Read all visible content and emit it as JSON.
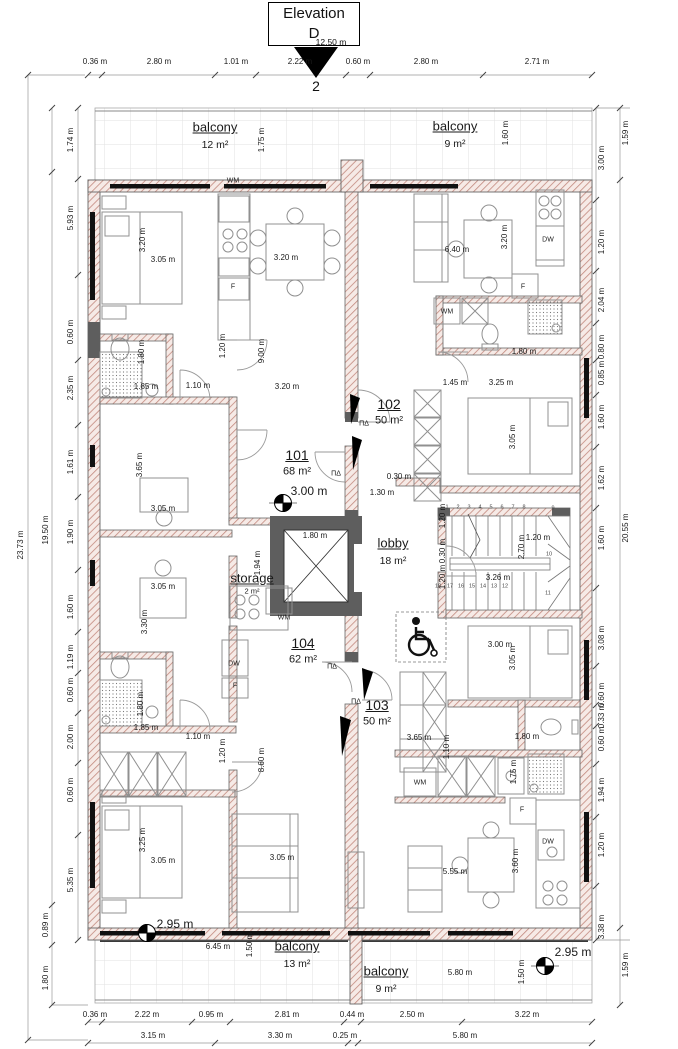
{
  "marker": {
    "title_line1": "Elevation",
    "title_line2": "D",
    "number": "2",
    "span_label": "12.50 m"
  },
  "colors": {
    "hatch_line": "#c2897e",
    "hatch_bg": "#f6eae6",
    "wall_dark": "#5e5e5e",
    "window": "#111111",
    "furniture": "#909090",
    "tile_line": "#e2e2e2",
    "dim_text": "#1a1a1a"
  },
  "dimensions": {
    "top": {
      "y": 62,
      "items": [
        {
          "t": "0.36 m",
          "x": 95
        },
        {
          "t": "2.80 m",
          "x": 159
        },
        {
          "t": "1.01 m",
          "x": 236
        },
        {
          "t": "2.22 m",
          "x": 300
        },
        {
          "t": "0.60 m",
          "x": 358
        },
        {
          "t": "2.80 m",
          "x": 426
        },
        {
          "t": "2.71 m",
          "x": 537
        }
      ]
    },
    "bottom1": {
      "y": 1015,
      "items": [
        {
          "t": "0.36 m",
          "x": 95
        },
        {
          "t": "2.22 m",
          "x": 147
        },
        {
          "t": "0.95 m",
          "x": 211
        },
        {
          "t": "2.81 m",
          "x": 287
        },
        {
          "t": "0.44 m",
          "x": 352
        },
        {
          "t": "2.50 m",
          "x": 412
        },
        {
          "t": "3.22 m",
          "x": 527
        }
      ]
    },
    "bottom2": {
      "y": 1036,
      "items": [
        {
          "t": "3.15 m",
          "x": 153
        },
        {
          "t": "3.30 m",
          "x": 280
        },
        {
          "t": "0.25 m",
          "x": 345
        },
        {
          "t": "5.80 m",
          "x": 465
        }
      ]
    },
    "left_inner": {
      "x": 71,
      "items": [
        {
          "t": "1.74 m",
          "y": 140
        },
        {
          "t": "5.93 m",
          "y": 218
        },
        {
          "t": "0.60 m",
          "y": 332
        },
        {
          "t": "2.35 m",
          "y": 388
        },
        {
          "t": "1.61 m",
          "y": 462
        },
        {
          "t": "1.90 m",
          "y": 532
        },
        {
          "t": "1.60 m",
          "y": 607
        },
        {
          "t": "1.19 m",
          "y": 657
        },
        {
          "t": "0.60 m",
          "y": 690
        },
        {
          "t": "2.00 m",
          "y": 737
        },
        {
          "t": "0.60 m",
          "y": 790
        },
        {
          "t": "5.35 m",
          "y": 880
        }
      ]
    },
    "left_mid": {
      "x": 46,
      "items": [
        {
          "t": "19.50 m",
          "y": 530
        },
        {
          "t": "0.89 m",
          "y": 925
        },
        {
          "t": "1.80 m",
          "y": 978
        }
      ]
    },
    "left_outer": {
      "x": 21,
      "items": [
        {
          "t": "23.73 m",
          "y": 545
        }
      ]
    },
    "right_inner": {
      "x": 602,
      "items": [
        {
          "t": "3.00 m",
          "y": 158
        },
        {
          "t": "1.20 m",
          "y": 242
        },
        {
          "t": "2.04 m",
          "y": 300
        },
        {
          "t": "0.80 m",
          "y": 347
        },
        {
          "t": "0.85 m",
          "y": 373
        },
        {
          "t": "1.60 m",
          "y": 417
        },
        {
          "t": "1.62 m",
          "y": 478
        },
        {
          "t": "1.60 m",
          "y": 538
        },
        {
          "t": "3.08 m",
          "y": 638
        },
        {
          "t": "0.60 m",
          "y": 695
        },
        {
          "t": "0.33 m",
          "y": 716
        },
        {
          "t": "0.60 m",
          "y": 739
        },
        {
          "t": "1.94 m",
          "y": 790
        },
        {
          "t": "1.20 m",
          "y": 845
        },
        {
          "t": "3.38 m",
          "y": 927
        }
      ]
    },
    "right_outer": {
      "x": 626,
      "items": [
        {
          "t": "1.59 m",
          "y": 133
        },
        {
          "t": "20.55 m",
          "y": 528
        },
        {
          "t": "1.59 m",
          "y": 965
        }
      ]
    }
  },
  "interior_dims": [
    {
      "t": "1.75 m",
      "x": 262,
      "y": 140,
      "v": 1
    },
    {
      "t": "1.60 m",
      "x": 506,
      "y": 133,
      "v": 1
    },
    {
      "t": "3.20 m",
      "x": 143,
      "y": 240,
      "v": 1
    },
    {
      "t": "3.05 m",
      "x": 163,
      "y": 260
    },
    {
      "t": "3.20 m",
      "x": 286,
      "y": 258
    },
    {
      "t": "6.40 m",
      "x": 457,
      "y": 250
    },
    {
      "t": "3.20 m",
      "x": 505,
      "y": 237,
      "v": 1
    },
    {
      "t": "1.80 m",
      "x": 524,
      "y": 352
    },
    {
      "t": "1.45 m",
      "x": 455,
      "y": 383
    },
    {
      "t": "3.25 m",
      "x": 501,
      "y": 383
    },
    {
      "t": "3.05 m",
      "x": 513,
      "y": 437,
      "v": 1
    },
    {
      "t": "3.00 m",
      "x": 309,
      "y": 491,
      "lg": 1
    },
    {
      "t": "0.30 m",
      "x": 399,
      "y": 477
    },
    {
      "t": "1.30 m",
      "x": 382,
      "y": 493
    },
    {
      "t": "1.80 m",
      "x": 142,
      "y": 352,
      "v": 1
    },
    {
      "t": "1.85 m",
      "x": 146,
      "y": 387
    },
    {
      "t": "1.10 m",
      "x": 198,
      "y": 386
    },
    {
      "t": "1.20 m",
      "x": 223,
      "y": 346,
      "v": 1
    },
    {
      "t": "9.00 m",
      "x": 262,
      "y": 351,
      "v": 1
    },
    {
      "t": "3.20 m",
      "x": 287,
      "y": 387
    },
    {
      "t": "3.65 m",
      "x": 140,
      "y": 465,
      "v": 1
    },
    {
      "t": "3.05 m",
      "x": 163,
      "y": 509
    },
    {
      "t": "1.80 m",
      "x": 315,
      "y": 536
    },
    {
      "t": "1.94 m",
      "x": 258,
      "y": 563,
      "v": 1
    },
    {
      "t": "1.20 m",
      "x": 443,
      "y": 516,
      "v": 1
    },
    {
      "t": "0.30 m",
      "x": 443,
      "y": 551,
      "v": 1
    },
    {
      "t": "1.20 m",
      "x": 443,
      "y": 577,
      "v": 1
    },
    {
      "t": "2.70 m",
      "x": 522,
      "y": 547,
      "v": 1
    },
    {
      "t": "1.20 m",
      "x": 538,
      "y": 538
    },
    {
      "t": "3.26 m",
      "x": 498,
      "y": 578
    },
    {
      "t": "3.65 m",
      "x": 419,
      "y": 738
    },
    {
      "t": "1.10 m",
      "x": 447,
      "y": 747,
      "v": 1
    },
    {
      "t": "3.00 m",
      "x": 500,
      "y": 645
    },
    {
      "t": "3.05 m",
      "x": 513,
      "y": 658,
      "v": 1
    },
    {
      "t": "1.80 m",
      "x": 527,
      "y": 737
    },
    {
      "t": "1.75 m",
      "x": 514,
      "y": 772,
      "v": 1
    },
    {
      "t": "3.05 m",
      "x": 163,
      "y": 587
    },
    {
      "t": "3.30 m",
      "x": 145,
      "y": 622,
      "v": 1
    },
    {
      "t": "1.80 m",
      "x": 141,
      "y": 704,
      "v": 1
    },
    {
      "t": "1.85 m",
      "x": 146,
      "y": 728
    },
    {
      "t": "1.10 m",
      "x": 198,
      "y": 737
    },
    {
      "t": "1.20 m",
      "x": 223,
      "y": 751,
      "v": 1
    },
    {
      "t": "8.60 m",
      "x": 262,
      "y": 760,
      "v": 1
    },
    {
      "t": "3.25 m",
      "x": 143,
      "y": 840,
      "v": 1
    },
    {
      "t": "3.05 m",
      "x": 163,
      "y": 861
    },
    {
      "t": "3.05 m",
      "x": 282,
      "y": 858
    },
    {
      "t": "2.95 m",
      "x": 175,
      "y": 924,
      "lg": 1
    },
    {
      "t": "6.45 m",
      "x": 218,
      "y": 947
    },
    {
      "t": "1.50 m",
      "x": 250,
      "y": 945,
      "v": 1
    },
    {
      "t": "5.55 m",
      "x": 455,
      "y": 872
    },
    {
      "t": "3.60 m",
      "x": 516,
      "y": 861,
      "v": 1
    },
    {
      "t": "2.95 m",
      "x": 573,
      "y": 952,
      "lg": 1
    },
    {
      "t": "5.80 m",
      "x": 460,
      "y": 973
    },
    {
      "t": "1.50 m",
      "x": 522,
      "y": 972,
      "v": 1
    }
  ],
  "appliances": [
    {
      "t": "WM",
      "x": 233,
      "y": 181
    },
    {
      "t": "F",
      "x": 233,
      "y": 287
    },
    {
      "t": "DW",
      "x": 548,
      "y": 240
    },
    {
      "t": "F",
      "x": 523,
      "y": 287
    },
    {
      "t": "WM",
      "x": 447,
      "y": 312
    },
    {
      "t": "WM",
      "x": 284,
      "y": 618
    },
    {
      "t": "DW",
      "x": 234,
      "y": 664
    },
    {
      "t": "F",
      "x": 235,
      "y": 686
    },
    {
      "t": "WM",
      "x": 420,
      "y": 783
    },
    {
      "t": "F",
      "x": 522,
      "y": 810
    },
    {
      "t": "DW",
      "x": 548,
      "y": 842
    }
  ],
  "entrance_symbols": [
    {
      "t": "ΠΔ",
      "x": 364,
      "y": 424
    },
    {
      "t": "ΠΔ",
      "x": 336,
      "y": 474
    },
    {
      "t": "ΠΔ",
      "x": 332,
      "y": 667
    },
    {
      "t": "ΠΔ",
      "x": 356,
      "y": 702
    }
  ],
  "rooms": [
    {
      "name": "balcony",
      "area": "12 m²",
      "x": 215,
      "y": 127
    },
    {
      "name": "balcony",
      "area": "9 m²",
      "x": 455,
      "y": 126
    },
    {
      "name": "lobby",
      "area": "18 m²",
      "x": 393,
      "y": 543
    },
    {
      "name": "storage",
      "area": "2 m²",
      "x": 252,
      "y": 578,
      "small": 1
    },
    {
      "name": "balcony",
      "area": "13 m²",
      "x": 297,
      "y": 946
    },
    {
      "name": "balcony",
      "area": "9 m²",
      "x": 386,
      "y": 971
    }
  ],
  "units": [
    {
      "number": "101",
      "area": "68 m²",
      "x": 297,
      "y": 455
    },
    {
      "number": "102",
      "area": "50 m²",
      "x": 389,
      "y": 404
    },
    {
      "number": "103",
      "area": "50 m²",
      "x": 377,
      "y": 705
    },
    {
      "number": "104",
      "area": "62 m²",
      "x": 303,
      "y": 643
    }
  ],
  "stair_steps": [
    {
      "n": "1",
      "x": 447,
      "y": 508
    },
    {
      "n": "2",
      "x": 458,
      "y": 508
    },
    {
      "n": "3",
      "x": 469,
      "y": 508
    },
    {
      "n": "4",
      "x": 480,
      "y": 508
    },
    {
      "n": "5",
      "x": 491,
      "y": 508
    },
    {
      "n": "6",
      "x": 502,
      "y": 508
    },
    {
      "n": "7",
      "x": 513,
      "y": 508
    },
    {
      "n": "8",
      "x": 524,
      "y": 508
    },
    {
      "n": "9",
      "x": 553,
      "y": 509
    },
    {
      "n": "10",
      "x": 549,
      "y": 555
    },
    {
      "n": "11",
      "x": 548,
      "y": 594
    },
    {
      "n": "12",
      "x": 505,
      "y": 587
    },
    {
      "n": "13",
      "x": 494,
      "y": 587
    },
    {
      "n": "14",
      "x": 483,
      "y": 587
    },
    {
      "n": "15",
      "x": 472,
      "y": 587
    },
    {
      "n": "16",
      "x": 461,
      "y": 587
    },
    {
      "n": "17",
      "x": 450,
      "y": 587
    },
    {
      "n": "18",
      "x": 438,
      "y": 587
    }
  ]
}
